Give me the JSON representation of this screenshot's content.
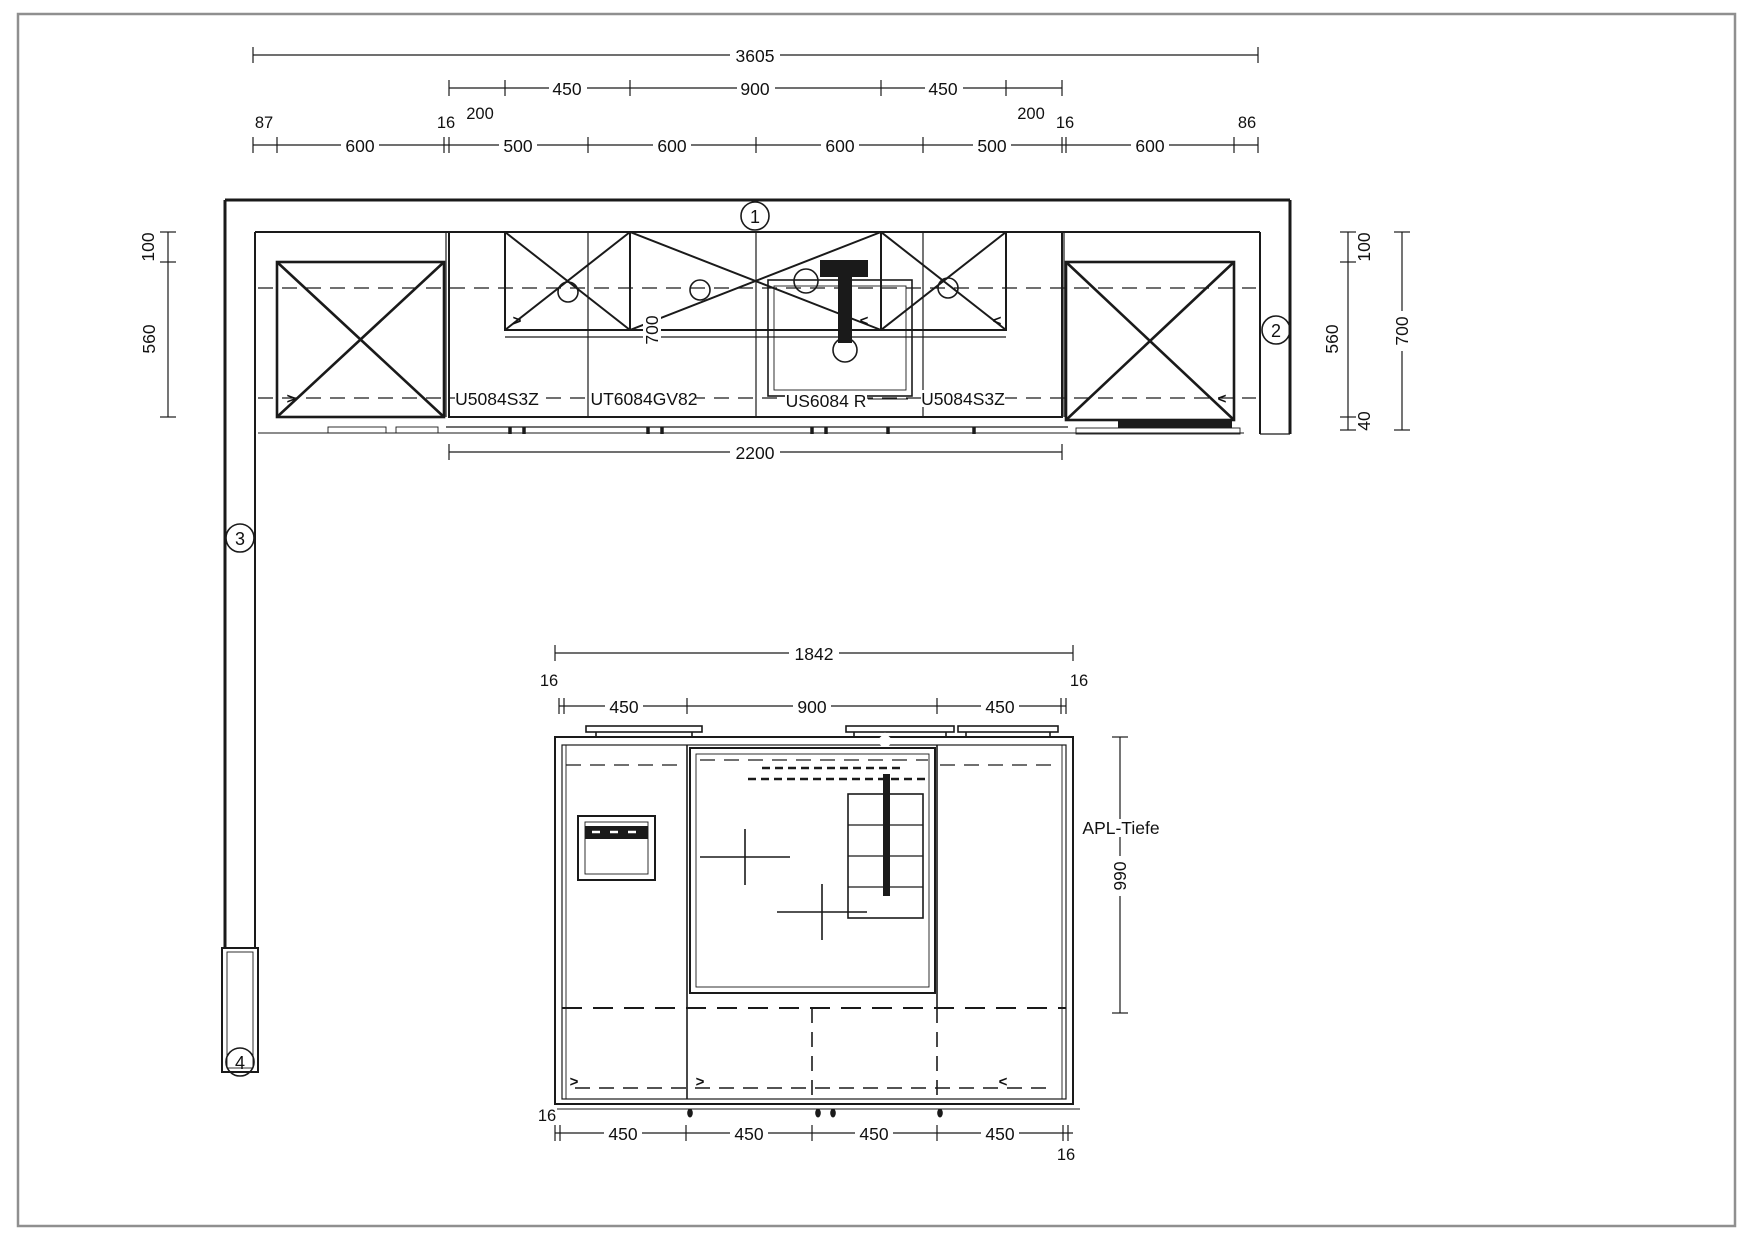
{
  "title": "Kitchen plan technical drawing",
  "colors": {
    "line": "#1a1a1a",
    "background": "#ffffff",
    "border": "#8f8f8f"
  },
  "symbols": {
    "open_right": ">",
    "open_left": "<"
  },
  "markers": [
    "1",
    "2",
    "3",
    "4"
  ],
  "top_view": {
    "dim_total": "3605",
    "dim_row2": [
      "450",
      "900",
      "450"
    ],
    "dim_row2_ends": [
      "200",
      "200"
    ],
    "dim_chain": [
      "600",
      "500",
      "600",
      "600",
      "500",
      "600"
    ],
    "dim_chain_small": [
      "87",
      "16",
      "16",
      "86"
    ],
    "dim_left": [
      "100",
      "560"
    ],
    "dim_right": [
      "100",
      "560",
      "40"
    ],
    "dim_right_total": "700",
    "dim_inner_depth": "700",
    "dim_run": "2200",
    "unit_labels": [
      "U5084S3Z",
      "UT6084GV82",
      "US6084 R",
      "U5084S3Z"
    ]
  },
  "island_view": {
    "dim_total": "1842",
    "dim_top": [
      "450",
      "900",
      "450"
    ],
    "dim_top_ends": [
      "16",
      "16"
    ],
    "dim_bottom": [
      "450",
      "450",
      "450",
      "450"
    ],
    "dim_bottom_ends": [
      "16",
      "16"
    ],
    "depth_label": "APL-Tiefe",
    "depth_value": "990"
  }
}
